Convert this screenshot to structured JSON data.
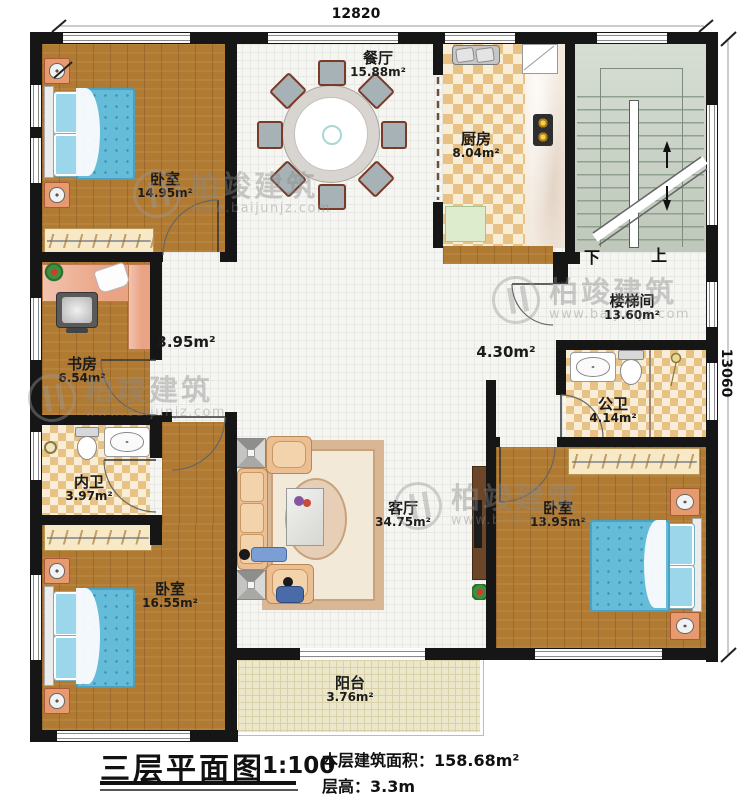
{
  "dimensions": {
    "top": "12820",
    "right": "13060"
  },
  "rooms": {
    "bedroom_tl": {
      "name": "卧室",
      "area": "14.95m²"
    },
    "dining": {
      "name": "餐厅",
      "area": "15.88m²"
    },
    "kitchen": {
      "name": "厨房",
      "area": "8.04m²"
    },
    "stairwell": {
      "name": "楼梯间",
      "area": "13.60m²"
    },
    "study": {
      "name": "书房",
      "area": "6.54m²"
    },
    "hall_left": {
      "area": "3.95m²"
    },
    "hall_right": {
      "area": "4.30m²"
    },
    "bath_private": {
      "name": "内卫",
      "area": "3.97m²"
    },
    "bath_public": {
      "name": "公卫",
      "area": "4.14m²"
    },
    "bedroom_bl": {
      "name": "卧室",
      "area": "16.55m²"
    },
    "living": {
      "name": "客厅",
      "area": "34.75m²"
    },
    "bedroom_r": {
      "name": "卧室",
      "area": "13.95m²"
    },
    "balcony": {
      "name": "阳台",
      "area": "3.76m²"
    }
  },
  "stairs": {
    "down": "下",
    "up": "上"
  },
  "title_block": {
    "title": "三层平面图",
    "scale": "1:100",
    "area_line": "本层建筑面积：158.68m²",
    "height_line": "层高：3.3m"
  },
  "watermark": {
    "brand": "柏竣建筑",
    "url": "www.baijunjz.com"
  }
}
